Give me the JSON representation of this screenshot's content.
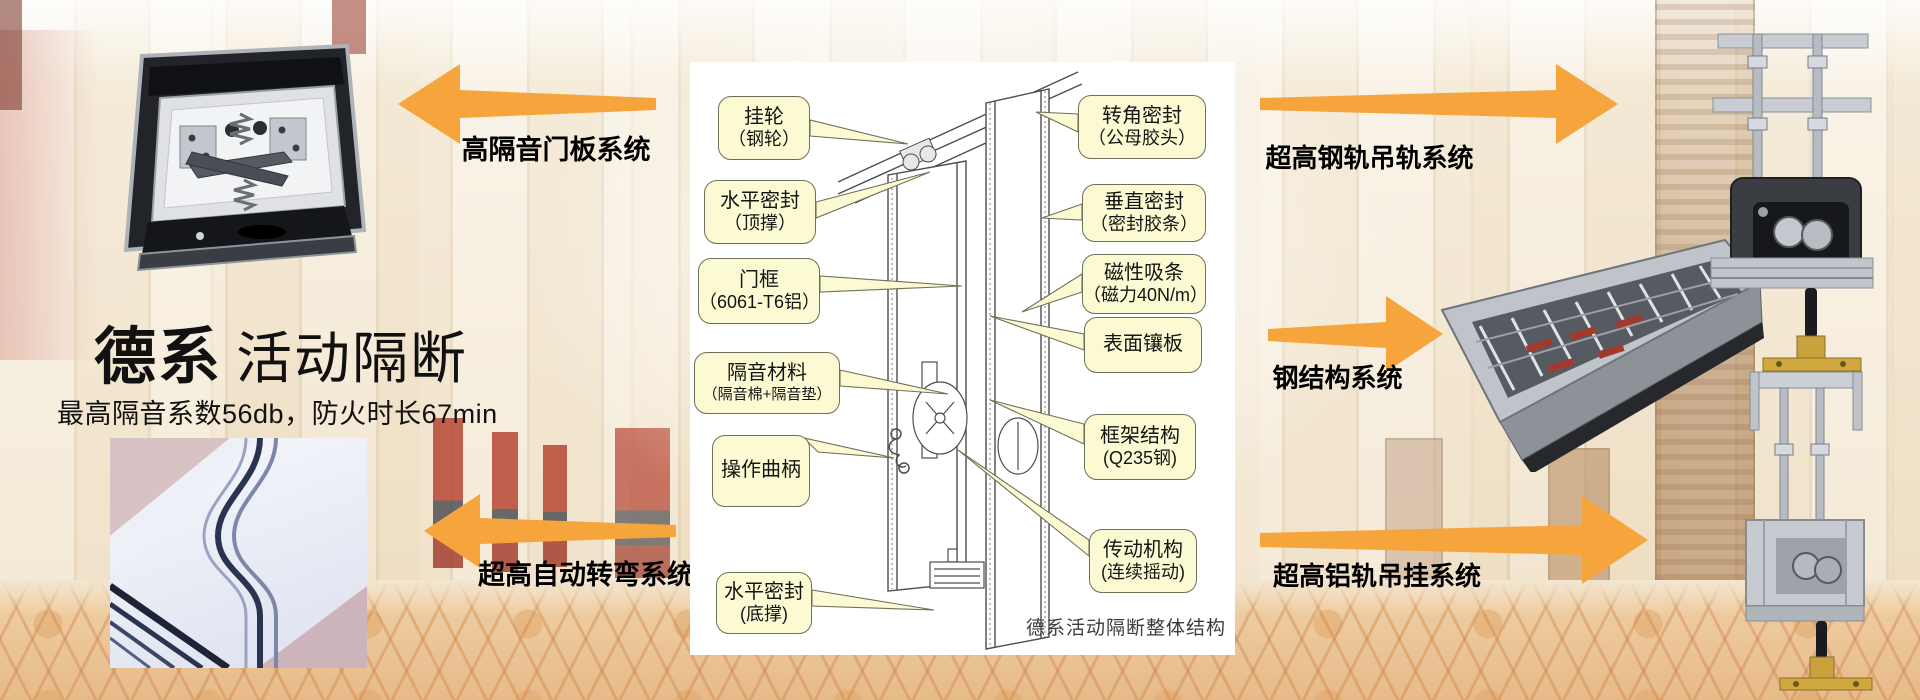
{
  "title": {
    "brand": "德系",
    "name": "活动隔断",
    "subtitle": "最高隔音系数56db，防火时长67min"
  },
  "systems": {
    "door_panel": "高隔音门板系统",
    "auto_turning": "超高自动转弯系统",
    "steel_rail": "超高钢轨吊轨系统",
    "steel_structure": "钢结构系统",
    "aluminum_rail": "超高铝轨吊挂系统"
  },
  "diagram": {
    "caption": "德系活动隔断整体结构",
    "callouts_left": [
      {
        "line1": "挂轮",
        "line2": "（钢轮）"
      },
      {
        "line1": "水平密封",
        "line2": "（顶撑）"
      },
      {
        "line1": "门框",
        "line2": "（6061-T6铝）"
      },
      {
        "line1": "隔音材料",
        "line2": "（隔音棉+隔音垫）"
      },
      {
        "line1": "操作曲柄",
        "line2": ""
      },
      {
        "line1": "水平密封",
        "line2": "(底撑)"
      }
    ],
    "callouts_right": [
      {
        "line1": "转角密封",
        "line2": "（公母胶头）"
      },
      {
        "line1": "垂直密封",
        "line2": "（密封胶条）"
      },
      {
        "line1": "磁性吸条",
        "line2": "（磁力40N/m）"
      },
      {
        "line1": "表面镶板",
        "line2": ""
      },
      {
        "line1": "框架结构",
        "line2": "(Q235钢)"
      },
      {
        "line1": "传动机构",
        "line2": "(连续摇动)"
      }
    ]
  },
  "colors": {
    "arrow": "#F6A53D",
    "callout_bg": "#FCFAD2",
    "callout_border": "#70705A",
    "panel_bg": "#FFFFFF"
  }
}
